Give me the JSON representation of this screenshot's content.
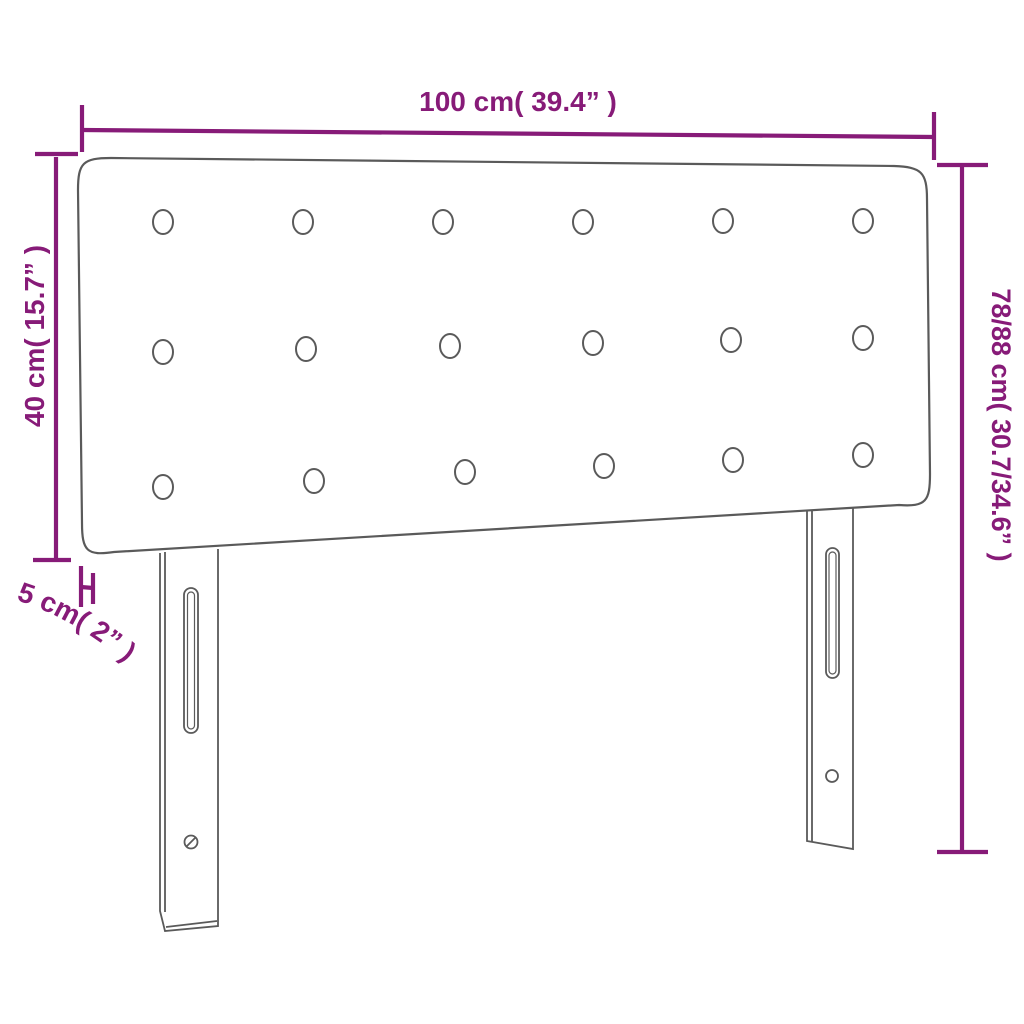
{
  "figure": {
    "type": "product-dimension-diagram",
    "background_color": "#ffffff",
    "colors": {
      "dimension_accent": "#871b78",
      "product_outline": "#5a5a5a"
    },
    "labels": {
      "width": "100 cm( 39.4” )",
      "headboard_height": "40 cm( 15.7” )",
      "thickness": "5 cm( 2” )",
      "total_height": "78/88 cm( 30.7/34.6” )"
    },
    "tufting": {
      "rows": 3,
      "columns": 6,
      "button_count": 18
    },
    "legs": 2
  }
}
